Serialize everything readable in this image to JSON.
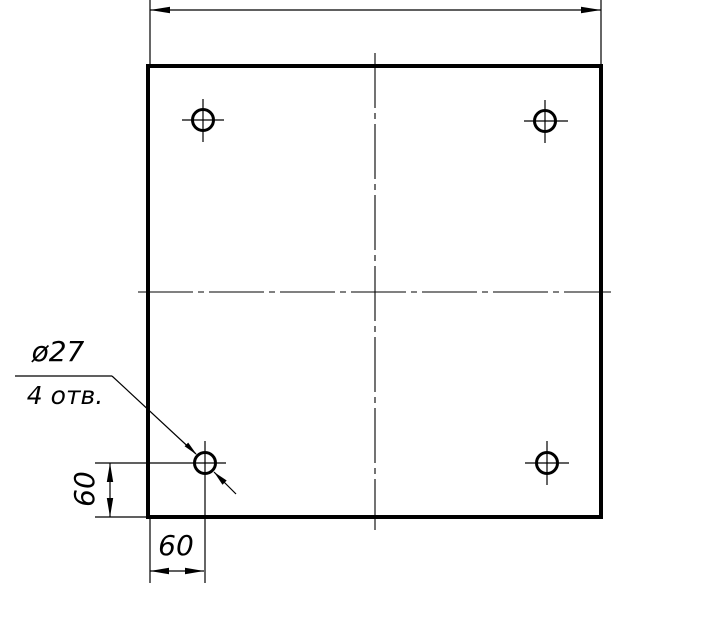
{
  "page": {
    "background_color": "#ffffff",
    "ink_color": "#000000",
    "type_note": "technical drawing of a square plate with four holes"
  },
  "callout": {
    "diameter_label": "ø27",
    "hole_count_label": "4 отв."
  },
  "dimensions": {
    "hole_offset_vertical": "60",
    "hole_offset_horizontal": "60",
    "overall_width_value": ""
  }
}
